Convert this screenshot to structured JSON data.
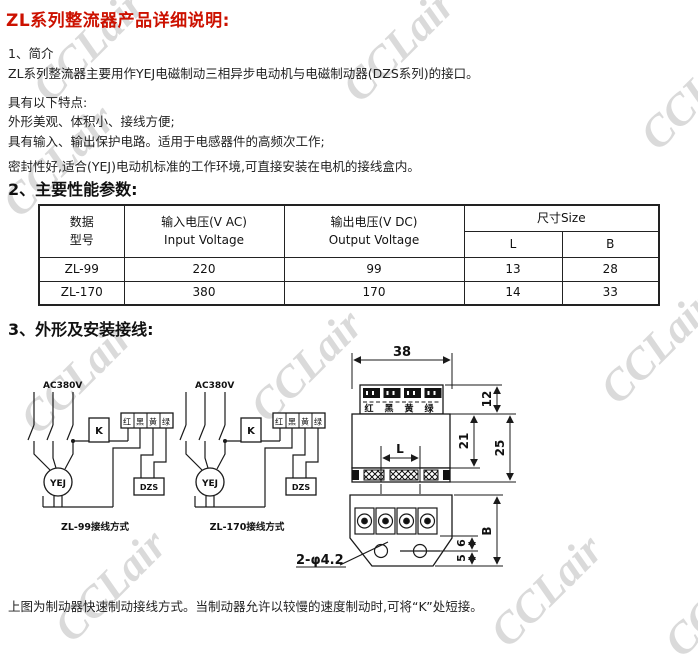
{
  "watermark": {
    "text": "CCLair",
    "color": "#dadada"
  },
  "title": "ZL系列整流器产品详细说明:",
  "intro": {
    "heading": "1、简介",
    "p1": "ZL系列整流器主要用作YEJ电磁制动三相异步电动机与电磁制动器(DZS系列)的接口。",
    "p2": "具有以下特点:",
    "p3": "外形美观、体积小、接线方便;",
    "p4": "具有输入、输出保护电路。适用于电感器件的高频次工作;",
    "p5": "密封性好,适合(YEJ)电动机标准的工作环境,可直接安装在电机的接线盒内。"
  },
  "params": {
    "heading": "2、主要性能参数:",
    "table": {
      "col_model_line1": "数据",
      "col_model_line2": "型号",
      "col_input_line1": "输入电压(V AC)",
      "col_input_line2": "Input Voltage",
      "col_output_line1": "输出电压(V DC)",
      "col_output_line2": "Output Voltage",
      "col_size": "尺寸Size",
      "col_L": "L",
      "col_B": "B",
      "rows": [
        [
          "ZL-99",
          "220",
          "99",
          "13",
          "28"
        ],
        [
          "ZL-170",
          "380",
          "170",
          "14",
          "33"
        ]
      ]
    }
  },
  "wiring": {
    "heading": "3、外形及安装接线:",
    "ac_label": "AC380V",
    "k_label": "K",
    "motor_label": "YEJ",
    "brake_label": "DZS",
    "terminals": [
      "红",
      "黑",
      "黄",
      "绿"
    ],
    "caption_zl99": "ZL-99接线方式",
    "caption_zl170": "ZL-170接线方式"
  },
  "drawing": {
    "dim_width": "38",
    "dim_strip": "12",
    "dim_inner": "21",
    "dim_body": "25",
    "dim_L": "L",
    "dim_B": "B",
    "dim_6": "6",
    "dim_5": "5",
    "holes_label": "2-φ4.2",
    "terminals": [
      "红",
      "黑",
      "黄",
      "绿"
    ]
  },
  "footer": "上图为制动器快速制动接线方式。当制动器允许以较慢的速度制动时,可将“K”处短接。"
}
